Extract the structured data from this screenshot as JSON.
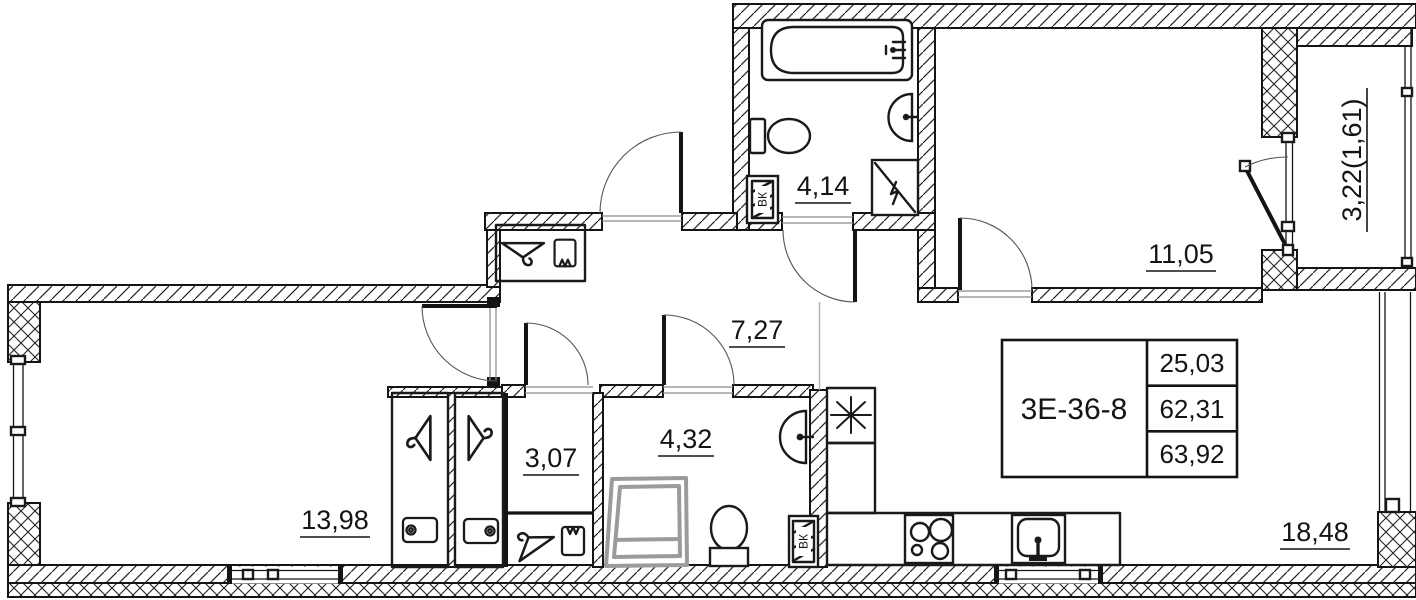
{
  "plan": {
    "stamp": {
      "unit": "3Е-36-8",
      "values": [
        "25,03",
        "62,31",
        "63,92"
      ]
    },
    "rooms": {
      "bathroom_top": "4,14",
      "bedroom": "11,05",
      "balcony": "3,22(1,61)",
      "hallway": "7,27",
      "living_left": "13,98",
      "storage": "3,07",
      "bathroom_bottom": "4,32",
      "kitchen_living": "18,48"
    },
    "shafts": {
      "top": "ВК",
      "bottom": "ВК"
    },
    "icons": {
      "vent": "asterisk-star",
      "hanger": "coat-hanger",
      "box": "storage-box",
      "basket": "shelf-basket",
      "bathtub": "bathtub",
      "sink": "wash-basin",
      "toilet": "toilet",
      "shower": "shower-tray",
      "stove": "cooktop-4-burner",
      "kitchen_sink": "kitchen-sink"
    },
    "colors": {
      "wall": "#141414",
      "shower": "#9b9b9b",
      "arc": "#555555"
    }
  }
}
